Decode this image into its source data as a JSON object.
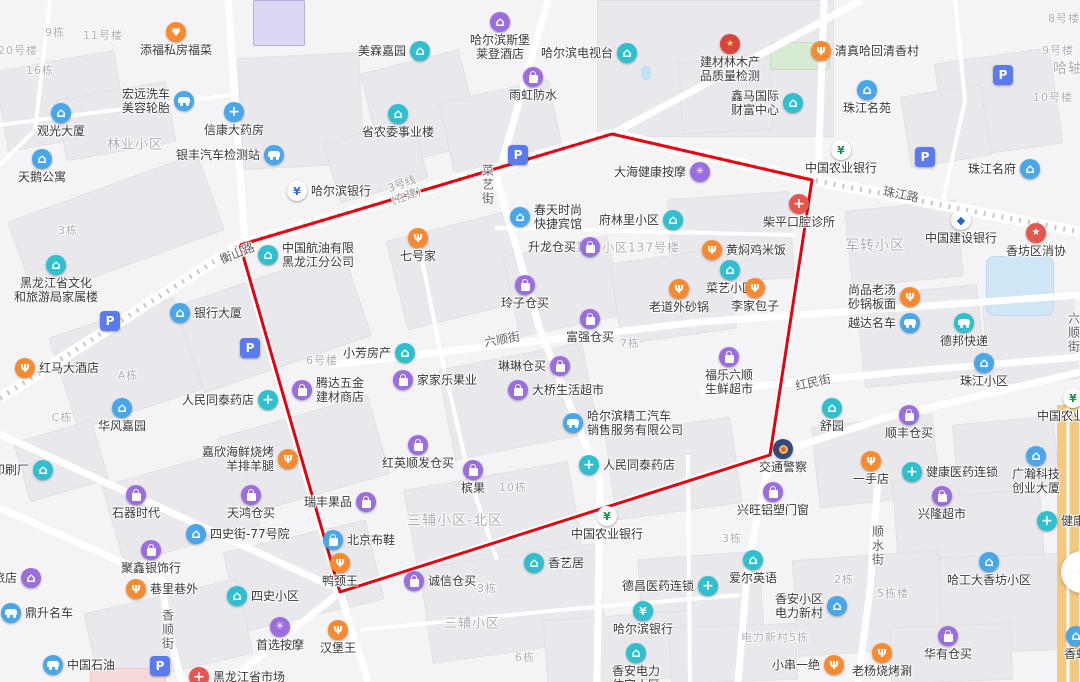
{
  "map": {
    "colors": {
      "orange": "#fb8a2e",
      "purple": "#9b6ee0",
      "teal": "#2fc0cf",
      "blue": "#48a6ea",
      "red": "#e4574e",
      "parking": "#5a7bf0",
      "boundary": "#e8000e",
      "metro": "#c6c8cc",
      "highway": "#f4c87e"
    },
    "boundary": {
      "points": [
        [
          240,
          245
        ],
        [
          612,
          134
        ],
        [
          812,
          180
        ],
        [
          770,
          455
        ],
        [
          340,
          592
        ]
      ]
    },
    "metro_line": {
      "path": [
        [
          0,
          398
        ],
        [
          240,
          245
        ],
        [
          612,
          134
        ],
        [
          812,
          180
        ],
        [
          1080,
          232
        ]
      ],
      "label_lines": [
        "3号线",
        "(在建)"
      ],
      "label_x": 404,
      "label_y": 190,
      "label_rot": -20
    },
    "street_labels": [
      {
        "text": "衡山路",
        "x": 237,
        "y": 253,
        "rot": -22
      },
      {
        "text": "珠江路",
        "x": 901,
        "y": 194,
        "rot": 11
      },
      {
        "text": "菜艺街",
        "x": 488,
        "y": 185,
        "vertical": true
      },
      {
        "text": "六顺街",
        "x": 502,
        "y": 339,
        "rot": -10
      },
      {
        "text": "红民街",
        "x": 813,
        "y": 382,
        "rot": -12
      },
      {
        "text": "顺水街",
        "x": 878,
        "y": 546,
        "vertical": true
      },
      {
        "text": "香顺街",
        "x": 168,
        "y": 630,
        "vertical": true
      },
      {
        "text": "六顺街",
        "x": 1074,
        "y": 333,
        "vertical": true
      }
    ],
    "area_labels": [
      {
        "text": "林业小区",
        "x": 135,
        "y": 143,
        "size": 13
      },
      {
        "text": "军转小区",
        "x": 875,
        "y": 245,
        "size": 14
      },
      {
        "text": "菜艺小区137号楼",
        "x": 628,
        "y": 247,
        "size": 12
      },
      {
        "text": "三辅小区-北区",
        "x": 455,
        "y": 520,
        "size": 14
      },
      {
        "text": "三辅小区",
        "x": 472,
        "y": 622,
        "size": 13
      },
      {
        "text": "20号楼",
        "x": 18,
        "y": 50,
        "size": 11
      },
      {
        "text": "9栋",
        "x": 55,
        "y": 32,
        "size": 11
      },
      {
        "text": "11号楼",
        "x": 103,
        "y": 35,
        "size": 11
      },
      {
        "text": "16栋",
        "x": 40,
        "y": 70,
        "size": 11
      },
      {
        "text": "3栋",
        "x": 68,
        "y": 230,
        "size": 11
      },
      {
        "text": "8号楼",
        "x": 1064,
        "y": 18,
        "size": 11
      },
      {
        "text": "9号楼",
        "x": 1058,
        "y": 50,
        "size": 11
      },
      {
        "text": "哈轴",
        "x": 1068,
        "y": 68,
        "size": 14
      },
      {
        "text": "10号楼",
        "x": 1053,
        "y": 97,
        "size": 11
      },
      {
        "text": "6号楼",
        "x": 322,
        "y": 360,
        "size": 11
      },
      {
        "text": "A栋",
        "x": 128,
        "y": 375,
        "size": 11
      },
      {
        "text": "C栋",
        "x": 62,
        "y": 417,
        "size": 11
      },
      {
        "text": "7栋",
        "x": 630,
        "y": 343,
        "size": 11
      },
      {
        "text": "10栋",
        "x": 513,
        "y": 487,
        "size": 11
      },
      {
        "text": "3栋",
        "x": 487,
        "y": 588,
        "size": 11
      },
      {
        "text": "3栋",
        "x": 732,
        "y": 538,
        "size": 11
      },
      {
        "text": "6栋",
        "x": 525,
        "y": 657,
        "size": 11
      },
      {
        "text": "2栋",
        "x": 844,
        "y": 579,
        "size": 11
      },
      {
        "text": "5栋楼",
        "x": 893,
        "y": 593,
        "size": 11
      },
      {
        "text": "电力新村5栋",
        "x": 775,
        "y": 637,
        "size": 11
      }
    ],
    "pois": [
      {
        "l": "添福私房福菜",
        "x": 176,
        "y": 32,
        "i": "heart",
        "c": "orange",
        "p": "below"
      },
      {
        "l": "宏远洗车美容轮胎",
        "ln": [
          "宏远洗车",
          "美容轮胎"
        ],
        "x": 184,
        "y": 101,
        "i": "car",
        "c": "blue",
        "p": "left"
      },
      {
        "l": "观光大厦",
        "x": 61,
        "y": 113,
        "i": "house",
        "c": "blue",
        "p": "below"
      },
      {
        "l": "信康大药房",
        "x": 234,
        "y": 112,
        "i": "pill",
        "c": "blue",
        "p": "below"
      },
      {
        "l": "银丰汽车检测站",
        "x": 274,
        "y": 155,
        "i": "car",
        "c": "blue",
        "p": "left"
      },
      {
        "l": "天鹅公寓",
        "x": 42,
        "y": 159,
        "i": "house",
        "c": "blue",
        "p": "below"
      },
      {
        "l": "美霖嘉园",
        "x": 420,
        "y": 51,
        "i": "house",
        "c": "teal",
        "p": "left"
      },
      {
        "l": "哈尔滨斯堡莱登酒店",
        "ln": [
          "哈尔滨斯堡",
          "莱登酒店"
        ],
        "x": 500,
        "y": 22,
        "i": "house",
        "c": "purple",
        "p": "below"
      },
      {
        "l": "雨虹防水",
        "x": 533,
        "y": 77,
        "i": "bag",
        "c": "purple",
        "p": "below"
      },
      {
        "l": "哈尔滨电视台",
        "x": 627,
        "y": 53,
        "i": "house",
        "c": "teal",
        "p": "left"
      },
      {
        "l": "省农委事业楼",
        "x": 398,
        "y": 114,
        "i": "house",
        "c": "teal",
        "p": "below"
      },
      {
        "l": "建材林木产品质量检测",
        "ln": [
          "建材林木产",
          "品质量检测"
        ],
        "x": 730,
        "y": 44,
        "i": "gov",
        "c": "red",
        "p": "below"
      },
      {
        "l": "清真哈回清香村",
        "x": 821,
        "y": 51,
        "i": "food",
        "c": "orange",
        "p": "right"
      },
      {
        "l": "鑫马国际财富中心",
        "ln": [
          "鑫马国际",
          "财富中心"
        ],
        "x": 793,
        "y": 103,
        "i": "house",
        "c": "teal",
        "p": "left"
      },
      {
        "l": "珠江名苑",
        "x": 867,
        "y": 90,
        "i": "house",
        "c": "blue",
        "p": "below"
      },
      {
        "l": "中国农业银行",
        "x": 841,
        "y": 150,
        "i": "bank-abc",
        "c": "blue",
        "p": "below"
      },
      {
        "l": "珠江名府",
        "x": 1030,
        "y": 169,
        "i": "house",
        "c": "blue",
        "p": "left"
      },
      {
        "l": "中国建设银行",
        "x": 961,
        "y": 220,
        "i": "bank-ccb",
        "c": "blue",
        "p": "below"
      },
      {
        "l": "香坊区消协",
        "x": 1036,
        "y": 233,
        "i": "star",
        "c": "red",
        "p": "below"
      },
      {
        "l": "柴平口腔诊所",
        "x": 799,
        "y": 204,
        "i": "cross",
        "c": "red",
        "p": "below"
      },
      {
        "l": "大海健康按摩",
        "x": 700,
        "y": 172,
        "i": "spa",
        "c": "purple",
        "p": "left"
      },
      {
        "l": "哈尔滨银行",
        "x": 297,
        "y": 191,
        "i": "bank-hrb",
        "c": "blue",
        "p": "right"
      },
      {
        "l": "中国航油有限黑龙江分公司",
        "ln": [
          "中国航油有限",
          "黑龙江分公司"
        ],
        "x": 268,
        "y": 255,
        "i": "house",
        "c": "teal",
        "p": "right"
      },
      {
        "l": "春天时尚快捷宾馆",
        "ln": [
          "春天时尚",
          "快捷宾馆"
        ],
        "x": 520,
        "y": 217,
        "i": "house",
        "c": "blue",
        "p": "right"
      },
      {
        "l": "府林里小区",
        "x": 673,
        "y": 220,
        "i": "house",
        "c": "teal",
        "p": "left"
      },
      {
        "l": "七号家",
        "x": 418,
        "y": 238,
        "i": "food",
        "c": "orange",
        "p": "below"
      },
      {
        "l": "升龙仓买",
        "x": 590,
        "y": 247,
        "i": "bag",
        "c": "purple",
        "p": "left"
      },
      {
        "l": "黄焖鸡米饭",
        "x": 712,
        "y": 250,
        "i": "food",
        "c": "orange",
        "p": "right"
      },
      {
        "l": "菜艺小区",
        "x": 730,
        "y": 270,
        "i": "house",
        "c": "teal",
        "p": "below"
      },
      {
        "l": "玲子仓买",
        "x": 525,
        "y": 285,
        "i": "bag",
        "c": "purple",
        "p": "below"
      },
      {
        "l": "老道外砂锅",
        "x": 679,
        "y": 289,
        "i": "food",
        "c": "orange",
        "p": "below"
      },
      {
        "l": "李家包子",
        "x": 755,
        "y": 288,
        "i": "food",
        "c": "orange",
        "p": "below"
      },
      {
        "l": "黑龙江省文化和旅游局家属楼",
        "ln": [
          "黑龙江省文化",
          "和旅游局家属楼"
        ],
        "x": 56,
        "y": 265,
        "i": "house",
        "c": "teal",
        "p": "below"
      },
      {
        "l": "银行大厦",
        "x": 180,
        "y": 313,
        "i": "house",
        "c": "blue",
        "p": "right"
      },
      {
        "l": "红马大酒店",
        "x": 25,
        "y": 368,
        "i": "food",
        "c": "orange",
        "p": "right"
      },
      {
        "l": "人民同泰药店",
        "x": 268,
        "y": 400,
        "i": "pill",
        "c": "teal",
        "p": "left"
      },
      {
        "l": "腾达五金建材商店",
        "ln": [
          "腾达五金",
          "建材商店"
        ],
        "x": 302,
        "y": 390,
        "i": "bag",
        "c": "purple",
        "p": "right"
      },
      {
        "l": "华风嘉园",
        "x": 122,
        "y": 408,
        "i": "house",
        "c": "blue",
        "p": "below"
      },
      {
        "l": "嘉欣海鲜烧烤羊排羊腿",
        "ln": [
          "嘉欣海鲜烧烤",
          "羊排羊腿"
        ],
        "x": 288,
        "y": 459,
        "i": "food",
        "c": "orange",
        "p": "left"
      },
      {
        "l": "尚品老汤砂锅板面",
        "ln": [
          "尚品老汤",
          "砂锅板面"
        ],
        "x": 910,
        "y": 297,
        "i": "food",
        "c": "orange",
        "p": "left"
      },
      {
        "l": "越达名车",
        "x": 910,
        "y": 323,
        "i": "car",
        "c": "blue",
        "p": "left"
      },
      {
        "l": "德邦快递",
        "x": 964,
        "y": 323,
        "i": "car",
        "c": "teal",
        "p": "below"
      },
      {
        "l": "珠江小区",
        "x": 984,
        "y": 363,
        "i": "house",
        "c": "blue",
        "p": "below"
      },
      {
        "l": "小芳房产",
        "x": 405,
        "y": 353,
        "i": "house",
        "c": "teal",
        "p": "left"
      },
      {
        "l": "富强仓买",
        "x": 590,
        "y": 319,
        "i": "bag",
        "c": "purple",
        "p": "below"
      },
      {
        "l": "琳琳仓买",
        "x": 560,
        "y": 366,
        "i": "bag",
        "c": "purple",
        "p": "left"
      },
      {
        "l": "家家乐果业",
        "x": 403,
        "y": 380,
        "i": "bag",
        "c": "purple",
        "p": "right"
      },
      {
        "l": "大桥生活超市",
        "x": 518,
        "y": 390,
        "i": "bag",
        "c": "purple",
        "p": "right"
      },
      {
        "l": "福乐六顺生鲜超市",
        "ln": [
          "福乐六顺",
          "生鲜超市"
        ],
        "x": 729,
        "y": 357,
        "i": "bag",
        "c": "purple",
        "p": "below"
      },
      {
        "l": "哈尔滨精工汽车销售服务有限公司",
        "ln": [
          "哈尔滨精工汽车",
          "销售服务有限公司"
        ],
        "x": 573,
        "y": 423,
        "i": "car",
        "c": "blue",
        "p": "right"
      },
      {
        "l": "红英顺发仓买",
        "x": 418,
        "y": 445,
        "i": "bag",
        "c": "purple",
        "p": "below"
      },
      {
        "l": "人民同泰药店",
        "x": 589,
        "y": 465,
        "i": "pill",
        "c": "teal",
        "p": "right"
      },
      {
        "l": "舒园",
        "x": 832,
        "y": 408,
        "i": "house",
        "c": "teal",
        "p": "below"
      },
      {
        "l": "顺丰仓买",
        "x": 909,
        "y": 415,
        "i": "bag",
        "c": "purple",
        "p": "below"
      },
      {
        "l": "中国农业银行",
        "x": 607,
        "y": 516,
        "i": "bank-abc",
        "c": "blue",
        "p": "below"
      },
      {
        "l": "中国农业银行",
        "x": 1073,
        "y": 398,
        "i": "bank-abc",
        "c": "blue",
        "p": "below"
      },
      {
        "l": "交通警察",
        "x": 783,
        "y": 449,
        "i": "police",
        "c": "blue",
        "p": "below"
      },
      {
        "l": "一手店",
        "x": 871,
        "y": 461,
        "i": "food",
        "c": "orange",
        "p": "below"
      },
      {
        "l": "健康医药连锁",
        "x": 912,
        "y": 472,
        "i": "pill",
        "c": "teal",
        "p": "right"
      },
      {
        "l": "健康医药连锁",
        "x": 1047,
        "y": 521,
        "i": "pill",
        "c": "teal",
        "p": "right"
      },
      {
        "l": "广瀚科技创业大厦",
        "ln": [
          "广瀚科技",
          "创业大厦"
        ],
        "x": 1036,
        "y": 456,
        "i": "house",
        "c": "blue",
        "p": "below"
      },
      {
        "l": "兴旺铝塑门窗",
        "x": 773,
        "y": 492,
        "i": "bag",
        "c": "purple",
        "p": "below"
      },
      {
        "l": "兴隆超市",
        "x": 942,
        "y": 496,
        "i": "bag",
        "c": "purple",
        "p": "below"
      },
      {
        "l": "石器时代",
        "x": 136,
        "y": 495,
        "i": "bag",
        "c": "purple",
        "p": "below"
      },
      {
        "l": "天鸿仓买",
        "x": 251,
        "y": 495,
        "i": "bag",
        "c": "purple",
        "p": "below"
      },
      {
        "l": "四史街-77号院",
        "x": 196,
        "y": 534,
        "i": "house",
        "c": "blue",
        "p": "right"
      },
      {
        "l": "瑞丰果品",
        "x": 366,
        "y": 502,
        "i": "bag",
        "c": "purple",
        "p": "left"
      },
      {
        "l": "槟果",
        "x": 473,
        "y": 470,
        "i": "bag",
        "c": "purple",
        "p": "below"
      },
      {
        "l": "聚鑫银饰行",
        "x": 151,
        "y": 550,
        "i": "bag",
        "c": "purple",
        "p": "below"
      },
      {
        "l": "北京布鞋",
        "x": 333,
        "y": 540,
        "i": "bag",
        "c": "blue",
        "p": "right"
      },
      {
        "l": "鸭颈王",
        "x": 340,
        "y": 563,
        "i": "food",
        "c": "orange",
        "p": "below"
      },
      {
        "l": "巷里巷外",
        "x": 136,
        "y": 589,
        "i": "food",
        "c": "orange",
        "p": "right"
      },
      {
        "l": "旅店",
        "x": 31,
        "y": 578,
        "i": "house",
        "c": "purple",
        "p": "left"
      },
      {
        "l": "鼎升名车",
        "x": 11,
        "y": 613,
        "i": "car",
        "c": "blue",
        "p": "right"
      },
      {
        "l": "四史小区",
        "x": 237,
        "y": 596,
        "i": "house",
        "c": "teal",
        "p": "right"
      },
      {
        "l": "首选按摩",
        "x": 280,
        "y": 627,
        "i": "spa",
        "c": "purple",
        "p": "below"
      },
      {
        "l": "汉堡王",
        "x": 338,
        "y": 630,
        "i": "food",
        "c": "orange",
        "p": "below"
      },
      {
        "l": "中国石油",
        "x": 53,
        "y": 665,
        "i": "car",
        "c": "blue",
        "p": "right"
      },
      {
        "l": "黑龙江省市场",
        "x": 199,
        "y": 677,
        "i": "cross",
        "c": "red",
        "p": "right"
      },
      {
        "l": "诚信仓买",
        "x": 414,
        "y": 581,
        "i": "bag",
        "c": "purple",
        "p": "right"
      },
      {
        "l": "香艺居",
        "x": 534,
        "y": 563,
        "i": "house",
        "c": "teal",
        "p": "right"
      },
      {
        "l": "德昌医药连锁",
        "x": 708,
        "y": 586,
        "i": "pill",
        "c": "teal",
        "p": "left"
      },
      {
        "l": "哈尔滨银行",
        "x": 643,
        "y": 611,
        "i": "yen",
        "c": "teal",
        "p": "below"
      },
      {
        "l": "爱尔英语",
        "x": 753,
        "y": 560,
        "i": "house",
        "c": "teal",
        "p": "below"
      },
      {
        "l": "香安小区电力新村",
        "ln": [
          "香安小区",
          "电力新村"
        ],
        "x": 837,
        "y": 606,
        "i": "house",
        "c": "blue",
        "p": "left"
      },
      {
        "l": "小串一绝",
        "x": 834,
        "y": 665,
        "i": "food",
        "c": "orange",
        "p": "left"
      },
      {
        "l": "老杨烧烤涮",
        "x": 882,
        "y": 653,
        "i": "food",
        "c": "orange",
        "p": "below"
      },
      {
        "l": "华有仓买",
        "x": 948,
        "y": 636,
        "i": "bag",
        "c": "purple",
        "p": "below"
      },
      {
        "l": "哈工大香坊小区",
        "x": 989,
        "y": 562,
        "i": "house",
        "c": "blue",
        "p": "below"
      },
      {
        "l": "香安电力住宅小区",
        "ln": [
          "香安电力",
          "住宅小区"
        ],
        "x": 636,
        "y": 653,
        "i": "house",
        "c": "teal",
        "p": "below"
      },
      {
        "l": "印刷厂",
        "x": 43,
        "y": 470,
        "i": "house",
        "c": "teal",
        "p": "left"
      },
      {
        "l": "香虹",
        "x": 1076,
        "y": 636,
        "i": "house",
        "c": "blue",
        "p": "below"
      },
      {
        "l": "",
        "x": 518,
        "y": 155,
        "i": "parking",
        "c": "parking",
        "p": "below"
      },
      {
        "l": "",
        "x": 925,
        "y": 157,
        "i": "parking",
        "c": "parking",
        "p": "below"
      },
      {
        "l": "",
        "x": 1003,
        "y": 75,
        "i": "parking",
        "c": "parking",
        "p": "below"
      },
      {
        "l": "",
        "x": 250,
        "y": 348,
        "i": "parking",
        "c": "parking",
        "p": "below"
      },
      {
        "l": "",
        "x": 110,
        "y": 321,
        "i": "parking",
        "c": "parking",
        "p": "below"
      },
      {
        "l": "",
        "x": 160,
        "y": 666,
        "i": "parking",
        "c": "parking",
        "p": "below"
      }
    ],
    "controls": {
      "compass_glyph": "("
    }
  }
}
